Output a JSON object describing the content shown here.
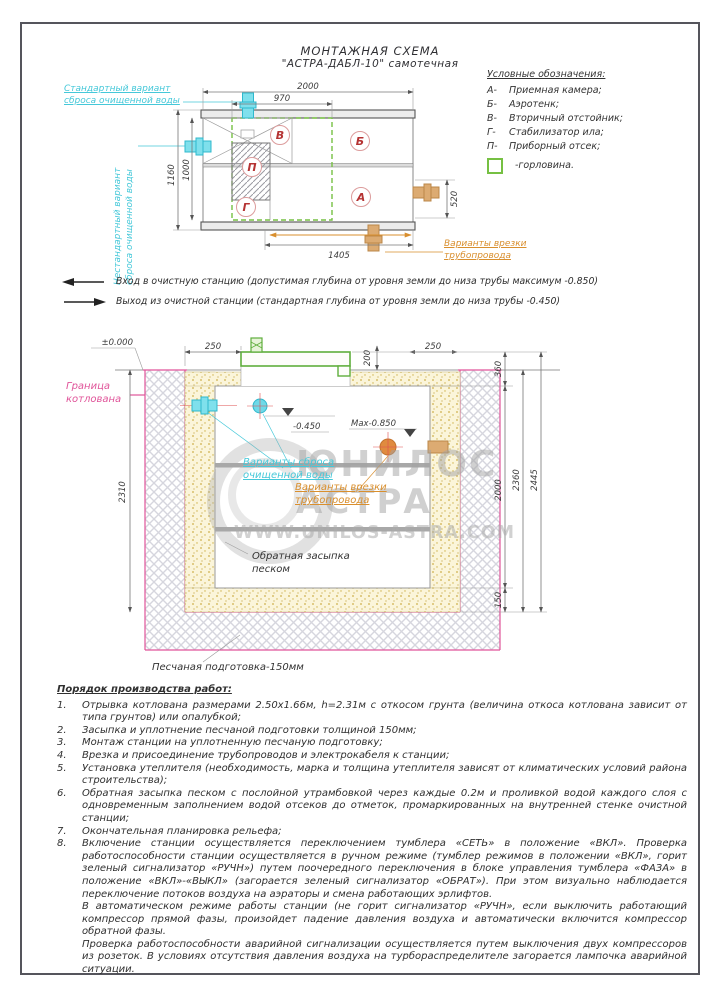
{
  "sheet": {
    "title1": "МОНТАЖНАЯ СХЕМА",
    "title2": "\"АСТРА-ДАБЛ-10\"  самотечная"
  },
  "legend": {
    "header": "Условные обозначения:",
    "items": [
      {
        "key": "А-",
        "label": "Приемная камера;"
      },
      {
        "key": "Б-",
        "label": "Аэротенк;"
      },
      {
        "key": "В-",
        "label": "Вторичный отстойник;"
      },
      {
        "key": "Г-",
        "label": "Стабилизатор ила;"
      },
      {
        "key": "П-",
        "label": "Приборный отсек;"
      }
    ],
    "gorlovina": "-горловина."
  },
  "top_view": {
    "sections": {
      "a": "А",
      "b": "Б",
      "v": "В",
      "g": "Г",
      "p": "П"
    },
    "dims": {
      "w2000": "2000",
      "w970": "970",
      "h1160": "1160",
      "h1000": "1000",
      "v520": "520",
      "w1405": "1405"
    },
    "labels": {
      "standard_l1": "Стандартный вариант",
      "standard_l2": "сброса очищенной воды",
      "nonstandard_l1": "Нестандартный вариант",
      "nonstandard_l2": "сброса очищенной воды",
      "tapin_l1": "Варианты врезки",
      "tapin_l2": "трубопровода"
    }
  },
  "notes": {
    "entry": "Вход в очистную станцию (допустимая глубина от уровня земли до низа трубы максимум -0.850)",
    "exit": "Выход из очистной станции (стандартная глубина от уровня земли до низа трубы -0.450)"
  },
  "cross_section": {
    "dims": {
      "zero": "±0.000",
      "left250": "250",
      "lid200": "200",
      "right250": "250",
      "v360": "360",
      "v2310": "2310",
      "v2000": "2000",
      "v2360": "2360",
      "v2445": "2445",
      "v150": "150",
      "lvl450": "-0.450",
      "lvl850": "Max-0.850"
    },
    "labels": {
      "boundary_l1": "Граница",
      "boundary_l2": "котлована",
      "discharge_l1": "Варианты сброса",
      "discharge_l2": "очищенной воды",
      "tapin_l1": "Варианты врезки",
      "tapin_l2": "трубопровода",
      "backfill_l1": "Обратная засыпка",
      "backfill_l2": "песком",
      "sand_base": "Песчаная подготовка-150мм"
    }
  },
  "watermark": {
    "brand1": "ЮНИЛОС",
    "brand2": "АСТРА",
    "url": "WWW.UNILOS-ASTRA.COM"
  },
  "worklist": {
    "header": "Порядок производства работ:",
    "items": [
      {
        "num": "1.",
        "text": "Отрывка котлована размерами 2.50х1.66м, h=2.31м с откосом грунта (величина откоса котлована зависит от типа грунтов) или опалубкой;"
      },
      {
        "num": "2.",
        "text": "Засыпка и уплотнение песчаной подготовки толщиной 150мм;"
      },
      {
        "num": "3.",
        "text": "Монтаж станции на уплотненную песчаную подготовку;"
      },
      {
        "num": "4.",
        "text": "Врезка и присоединение трубопроводов и электрокабеля к станции;"
      },
      {
        "num": "5.",
        "text": "Установка утеплителя (необходимость, марка и толщина утеплителя зависят от климатических условий района строительства);"
      },
      {
        "num": "6.",
        "text": "Обратная засыпка песком с послойной утрамбовкой через каждые 0.2м и проливкой водой каждого слоя с одновременным заполнением водой отсеков до отметок, промаркированных на внутренней стенке очистной станции;"
      },
      {
        "num": "7.",
        "text": "Окончательная планировка рельефа;"
      },
      {
        "num": "8.",
        "text": "Включение станции осуществляется переключением тумблера «СЕТЬ» в положение «ВКЛ». Проверка работоспособности станции осуществляется в ручном режиме (тумблер режимов в положении «ВКЛ», горит зеленый сигнализатор «РУЧН») путем поочередного переключения в блоке управления тумблера «ФАЗА»  в положение «ВКЛ»-«ВЫКЛ» (загорается зеленый сигнализатор «ОБРАТ»).   При этом визуально наблюдается переключение потоков воздуха на аэраторы и смена работающих эрлифтов."
      },
      {
        "num": "",
        "text": "В автоматическом режиме работы станции (не горит сигнализатор «РУЧН», если выключить работающий компрессор прямой фазы, произойдет падение давления воздуха и автоматически включится компрессор обратной фазы."
      },
      {
        "num": "",
        "text": "Проверка работоспособности аварийной сигнализации осуществляется путем выключения двух компрессоров из розеток. В условиях  отсутствия давления воздуха на турбораспределителе загорается лампочка аварийной ситуации."
      }
    ]
  }
}
